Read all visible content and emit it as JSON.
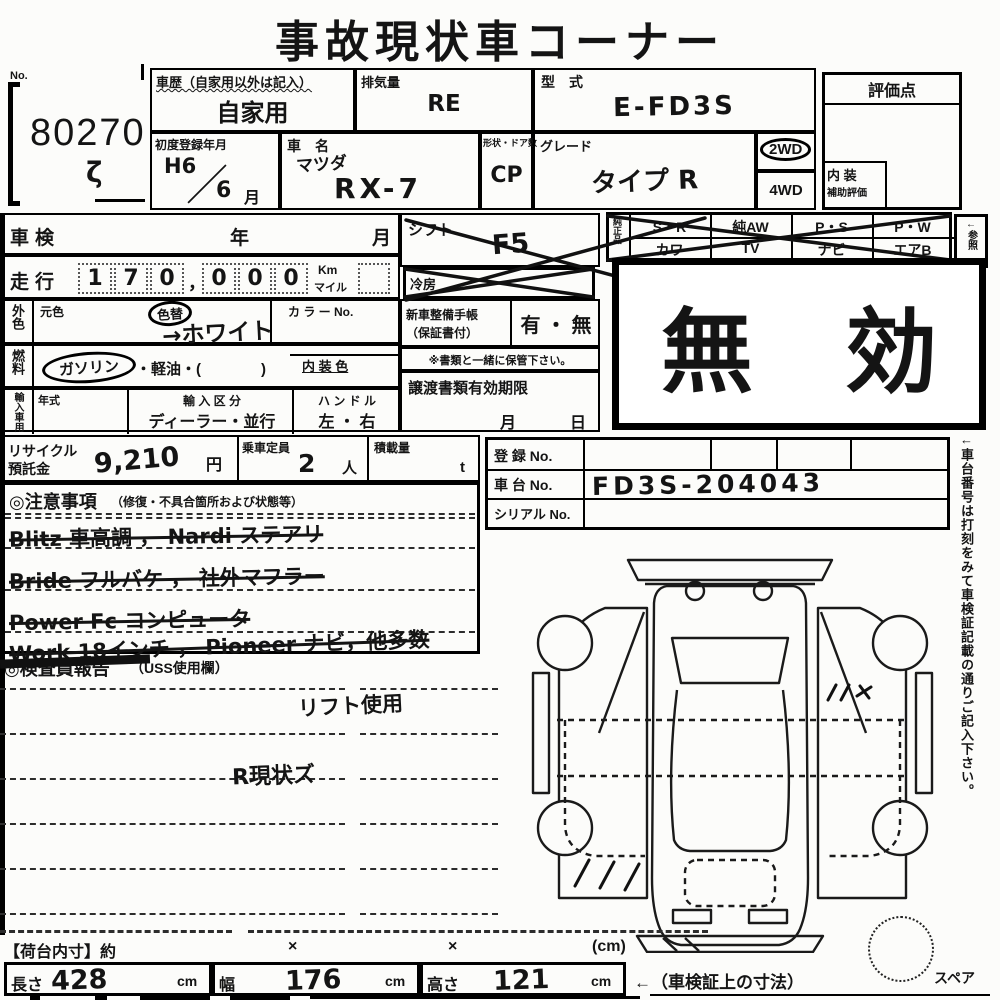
{
  "title": "事故現状車コーナー",
  "lot": {
    "no_label": "No.",
    "number": "80270",
    "squiggle": "ζ"
  },
  "header": {
    "history_label": "車歴（自家用以外は記入）",
    "history_value": "自家用",
    "displacement_label": "排気量",
    "displacement_value": "RE",
    "model_code_label": "型　式",
    "model_code_value": "E-FD3S",
    "first_reg_label": "初度登録年月",
    "first_reg_year": "H6",
    "first_reg_slash": "／",
    "first_reg_month": "6",
    "first_reg_month_label": "月",
    "make_label": "車　名",
    "make_value": "マツダ",
    "model_value": "RX-7",
    "body_label": "形状・ドア数",
    "body_value": "CP",
    "grade_label": "グレード",
    "grade_value": "タイプ R",
    "drive_2wd": "2WD",
    "drive_4wd": "4WD",
    "score_label": "評価点",
    "interior_label": "内 装",
    "interior_sub": "補助評価"
  },
  "left": {
    "shaken": "車検",
    "year": "年",
    "month": "月",
    "mileage": "走行",
    "digits": [
      "1",
      "7",
      "0",
      "0",
      "0",
      "0"
    ],
    "comma": "，",
    "km": "Km",
    "mile": "マイル",
    "ext_color": "外色",
    "orig_color": "元色",
    "color_change": "色替",
    "color_value": "→ホワイト",
    "color_no": "カ ラ ー No.",
    "fuel": "燃料",
    "gasoline": "ガソリン",
    "diesel": "・軽油・(　　　　)",
    "interior_color": "内 装 色",
    "import": "輸入車用",
    "year_model": "年式",
    "import_class": "輸 入 区 分",
    "import_value": "ディーラー・並行",
    "handle": "ハ ン ド ル",
    "handle_value": "左 ・ 右"
  },
  "middle": {
    "shift": "シフト",
    "shift_value": "F5",
    "cooler": "冷房",
    "booklet1": "新車整備手帳",
    "booklet2": "（保証書付）",
    "booklet_value": "有 ・ 無",
    "keep": "※書類と一緒に保管下さい。",
    "transfer": "譲渡書類有効期限",
    "t_month": "月",
    "t_day": "日"
  },
  "equipment": {
    "side": "純正品",
    "row1": [
      "S・R",
      "純AW",
      "P・S",
      "P・W"
    ],
    "row2": [
      "カワ",
      "TV",
      "ナビ",
      "エアB"
    ],
    "note": "←参照"
  },
  "stamp": "無　効",
  "reg": {
    "reg_no": "登 録 No.",
    "chassis": "車 台 No.",
    "chassis_value": "FD3S-204043",
    "serial": "シリアル No."
  },
  "recycle": {
    "l1": "リサイクル",
    "l2": "預託金",
    "value": "9,210",
    "yen": "円",
    "cap": "乗車定員",
    "cap_value": "2",
    "cap_unit": "人",
    "load": "積載量",
    "load_unit": "t"
  },
  "notes": {
    "head": "◎注意事項",
    "head_sub": "（修復・不具合箇所および状態等）",
    "lines": [
      "Blitz 車高調 ， Nardi ステアリ",
      "Bride フルバケ ， 社外マフラー",
      "Power Fc コンピュータ",
      "Work 18インチ ， Pioneer ナビ，他多数"
    ]
  },
  "inspector": {
    "head": "◎検査員報告",
    "head_sub": "（USS使用欄）",
    "note1": "リフト使用",
    "note2": "R現状ズ"
  },
  "diagram": {
    "spare": "スペア",
    "marks_left": "／ ／ ／",
    "marks_right": "ノノx"
  },
  "side_note": {
    "shi": "し",
    "text": "←車台番号は打刻をみて車検証記載の通りご記入下さい。"
  },
  "dims": {
    "bed": "【荷台内寸】約",
    "x": "×",
    "unit": "(cm)",
    "len": "長さ",
    "len_v": "428",
    "cm": "cm",
    "wid": "幅",
    "wid_v": "176",
    "hei": "高さ",
    "hei_v": "121",
    "arrow": "←（車検証上の寸法）"
  }
}
